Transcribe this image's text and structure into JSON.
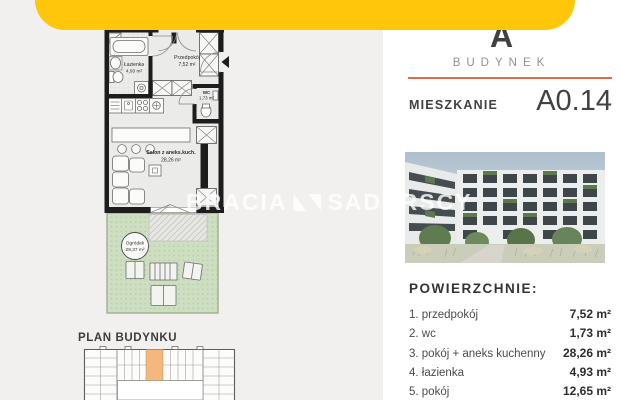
{
  "watermark": {
    "left": "BRACIA",
    "right": "SADURSCY"
  },
  "floorplan": {
    "rooms": {
      "bathroom": {
        "name": "Łazienka",
        "area": "4,93 m²"
      },
      "hallway": {
        "name": "Przedpokój",
        "area": "7,52 m²"
      },
      "wc": {
        "name": "WC",
        "area": "1,73 m²"
      },
      "living": {
        "name": "Salon z aneks.kuch.",
        "area": "28,26 m²"
      },
      "garden": {
        "name": "Ogródek",
        "area": "28,37 m²"
      }
    },
    "building_plan_title": "PLAN BUDYNKU"
  },
  "right": {
    "building_letter": "A",
    "building_label": "BUDYNEK",
    "apartment_label": "MIESZKANIE",
    "apartment_number": "A0.14",
    "areas_title": "POWIERZCHNIE:",
    "areas": [
      {
        "label": "1. przedpokój",
        "value": "7,52 m²"
      },
      {
        "label": "2. wc",
        "value": "1,73 m²"
      },
      {
        "label": "3. pokój + aneks kuchenny",
        "value": "28,26 m²"
      },
      {
        "label": "4. łazienka",
        "value": "4,93 m²"
      },
      {
        "label": "5. pokój",
        "value": "12,65 m²"
      }
    ]
  },
  "colors": {
    "brand_yellow": "#ffc60a",
    "accent_orange": "#dd6a4a",
    "highlight_unit": "#f4b77d",
    "garden_green": "#cedec1",
    "wall_black": "#1d1d1d",
    "panel_bg": "#f1f0ee"
  }
}
